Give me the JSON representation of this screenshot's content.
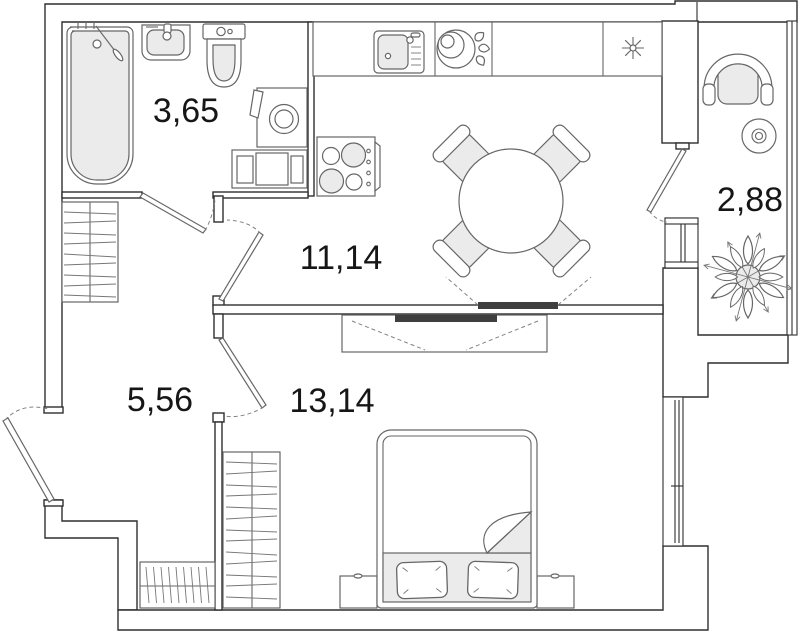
{
  "plan": {
    "type": "apartment-floor-plan",
    "rooms": [
      {
        "name": "bathroom",
        "area": "3,65"
      },
      {
        "name": "kitchen-dining",
        "area": "11,14"
      },
      {
        "name": "hallway",
        "area": "5,56"
      },
      {
        "name": "bedroom",
        "area": "13,14"
      },
      {
        "name": "balcony",
        "area": "2,88"
      }
    ]
  },
  "colors": {
    "background": "#ffffff",
    "wall_outline": "#2f2f2f",
    "furniture_line": "#666666",
    "light_fill": "#ebebeb",
    "tv_fill": "#3f3f3f",
    "label_text": "#161616"
  }
}
